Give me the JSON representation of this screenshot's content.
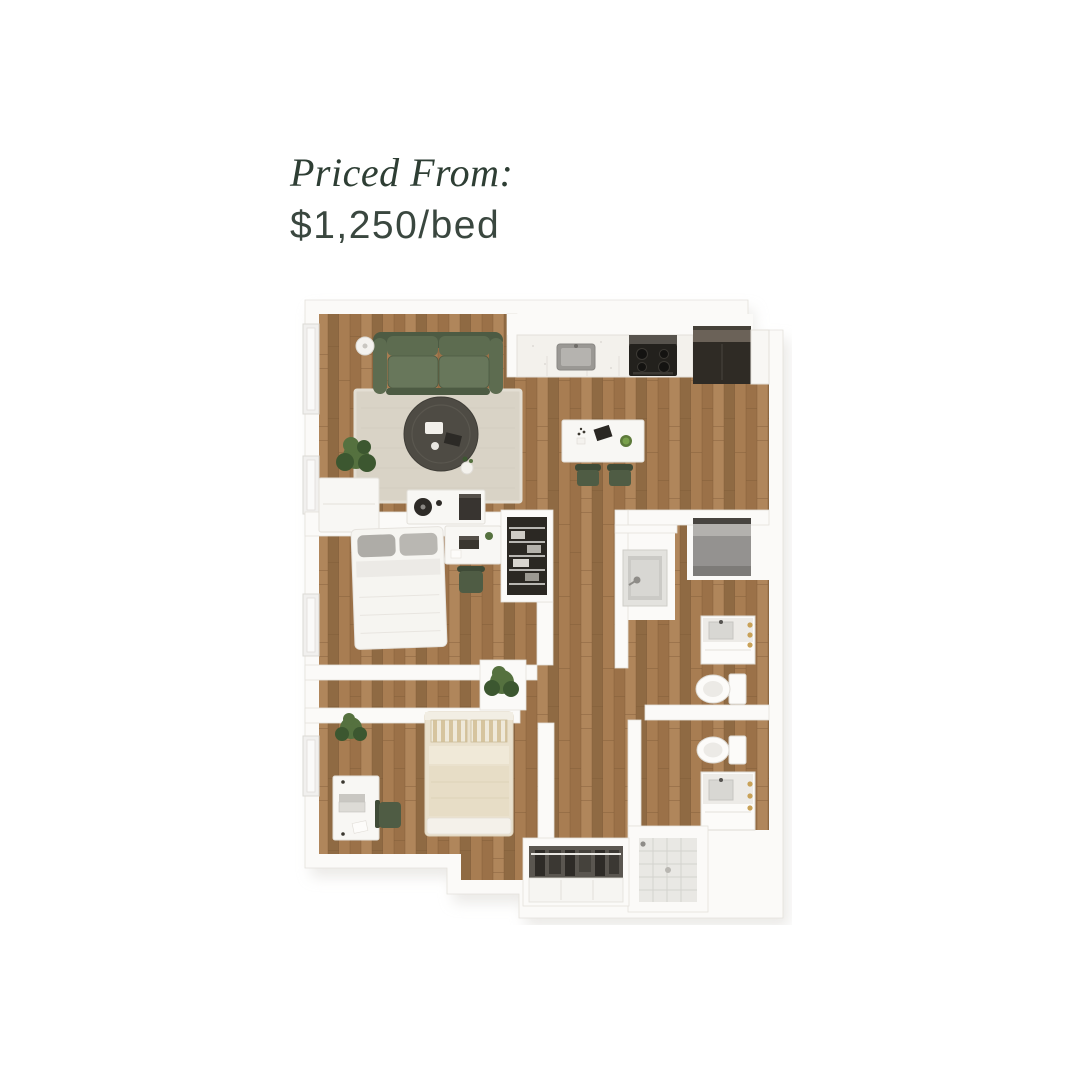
{
  "page": {
    "background": "#ffffff"
  },
  "header": {
    "priced_from_label": "Priced From:",
    "price": "$1,250/bed"
  },
  "floorplan": {
    "description": "3D top-down rendering of a two-bedroom, two-bathroom apartment floor plan with an open living room, kitchen and dining area, hallway, reach-in closets, wardrobe, laundry nook, green sofa, round coffee table, two beds, two desks and two bathrooms",
    "rooms": [
      "living room",
      "kitchen",
      "dining area",
      "bedroom 1",
      "bedroom 2",
      "bathroom 1",
      "bathroom 2",
      "hallway",
      "reach-in closet",
      "wardrobe closet",
      "laundry nook"
    ],
    "furniture": [
      "green sofa",
      "round coffee table",
      "area rug",
      "floor lamp",
      "potted plants",
      "media console",
      "storage cabinet",
      "dining table",
      "two dining chairs",
      "kitchen sink",
      "stove",
      "refrigerator",
      "white bed with gray pillows",
      "beige bed with striped pillows",
      "two desks with chairs",
      "wire shelving closet",
      "laundry basin",
      "washer-dryer",
      "two toilets",
      "two vanities",
      "tiled shower",
      "wardrobe with hanging clothes"
    ],
    "colors": {
      "ink": "#2e3e34",
      "price_ink": "#3a473f",
      "wall": "#fbfaf8",
      "wall_edge": "#e4e1db",
      "shadow": "#d7d4cf",
      "wood1": "#a87d52",
      "wood2": "#9b7148",
      "wood3": "#b0865b",
      "wood4": "#8f6a43",
      "wood_seam": "#7c5a38",
      "rug": "#d9d3c6",
      "rug_edge": "#e3ded3",
      "sofa": "#5d6c50",
      "sofa_light": "#68775b",
      "sofa_dark": "#4d5b43",
      "chair_green": "#4f5c44",
      "table_dark": "#4e4b44",
      "appliance_dark": "#2f2b25",
      "gray_box": "#949290",
      "tile": "#e9e8e4",
      "tile_line": "#d4d3ce",
      "plant": "#55713f",
      "plant_dark": "#3c5730",
      "bed_white": "#f6f5f1",
      "pillow_gray": "#aeaca7",
      "bed_beige": "#eae1cd",
      "gold": "#c9a258",
      "basin": "#d8d7d3"
    }
  }
}
